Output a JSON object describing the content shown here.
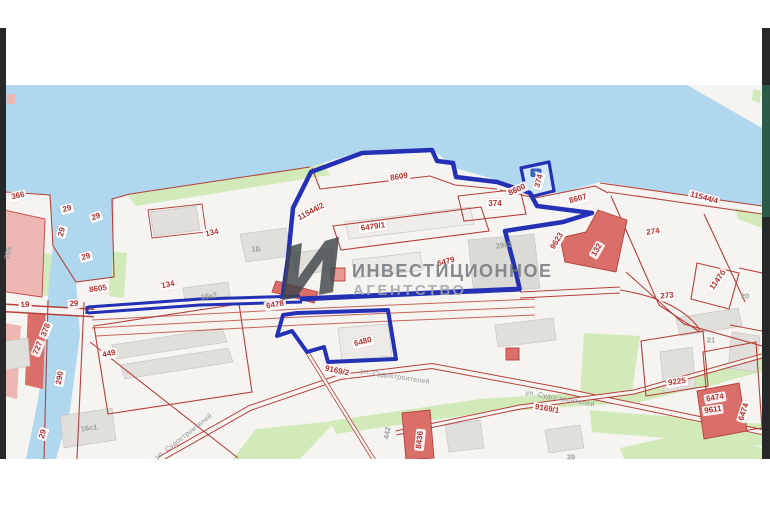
{
  "watermark": {
    "line1": "ИНВЕСТИЦИОННОЕ",
    "line2": "АГЕНТСТВО"
  },
  "map": {
    "type": "cadastral-parcel-map",
    "palette": {
      "water": "#afd7ee",
      "green": "#d2e9ba",
      "parcel_line": "#b5403c",
      "building_red": "#da6f6a",
      "building_pink": "#efb7b4",
      "selection_blue": "#2531b5",
      "label_red": "#b3322e",
      "label_gray": "#9aa09f",
      "frame_dark": "#26282a"
    },
    "labels": [
      {
        "text": "366",
        "x": 18,
        "y": 196,
        "rot": -12,
        "kind": "parcel"
      },
      {
        "text": "29",
        "x": 67,
        "y": 209,
        "rot": -15,
        "kind": "parcel"
      },
      {
        "text": "29",
        "x": 96,
        "y": 217,
        "rot": -20,
        "kind": "parcel"
      },
      {
        "text": "29",
        "x": 62,
        "y": 232,
        "rot": -75,
        "kind": "parcel"
      },
      {
        "text": "29",
        "x": 86,
        "y": 257,
        "rot": -15,
        "kind": "parcel"
      },
      {
        "text": "8605",
        "x": 98,
        "y": 289,
        "rot": -8,
        "kind": "parcel"
      },
      {
        "text": "29",
        "x": 74,
        "y": 304,
        "rot": -5,
        "kind": "parcel"
      },
      {
        "text": "19",
        "x": 25,
        "y": 305,
        "rot": -3,
        "kind": "parcel"
      },
      {
        "text": "134",
        "x": 212,
        "y": 233,
        "rot": -12,
        "kind": "parcel"
      },
      {
        "text": "134",
        "x": 168,
        "y": 285,
        "rot": -12,
        "kind": "parcel"
      },
      {
        "text": "16к2",
        "x": 209,
        "y": 296,
        "rot": -8,
        "kind": "gray"
      },
      {
        "text": "1Б",
        "x": 256,
        "y": 249,
        "rot": 0,
        "kind": "gray"
      },
      {
        "text": "11544/2",
        "x": 311,
        "y": 212,
        "rot": -28,
        "kind": "parcel"
      },
      {
        "text": "8609",
        "x": 399,
        "y": 177,
        "rot": -10,
        "kind": "parcel"
      },
      {
        "text": "6479/1",
        "x": 373,
        "y": 227,
        "rot": -8,
        "kind": "parcel"
      },
      {
        "text": "6479",
        "x": 446,
        "y": 262,
        "rot": -15,
        "kind": "parcel"
      },
      {
        "text": "374",
        "x": 495,
        "y": 204,
        "rot": 0,
        "kind": "parcel"
      },
      {
        "text": "8600",
        "x": 517,
        "y": 190,
        "rot": -25,
        "kind": "parcel"
      },
      {
        "text": "374",
        "x": 539,
        "y": 181,
        "rot": -75,
        "kind": "parcel"
      },
      {
        "text": "8607",
        "x": 578,
        "y": 199,
        "rot": -15,
        "kind": "parcel"
      },
      {
        "text": "9623",
        "x": 557,
        "y": 241,
        "rot": -60,
        "kind": "parcel"
      },
      {
        "text": "132",
        "x": 597,
        "y": 250,
        "rot": -60,
        "kind": "parcel"
      },
      {
        "text": "29к3",
        "x": 504,
        "y": 245,
        "rot": -8,
        "kind": "gray"
      },
      {
        "text": "274",
        "x": 653,
        "y": 232,
        "rot": -8,
        "kind": "parcel"
      },
      {
        "text": "11544/4",
        "x": 704,
        "y": 198,
        "rot": 15,
        "kind": "parcel"
      },
      {
        "text": "1147б",
        "x": 718,
        "y": 280,
        "rot": -55,
        "kind": "parcel"
      },
      {
        "text": "273",
        "x": 667,
        "y": 296,
        "rot": -5,
        "kind": "parcel"
      },
      {
        "text": "20",
        "x": 745,
        "y": 296,
        "rot": 0,
        "kind": "gray"
      },
      {
        "text": "21",
        "x": 711,
        "y": 340,
        "rot": 0,
        "kind": "gray"
      },
      {
        "text": "9225",
        "x": 677,
        "y": 382,
        "rot": -8,
        "kind": "parcel"
      },
      {
        "text": "6474",
        "x": 715,
        "y": 398,
        "rot": -10,
        "kind": "parcel"
      },
      {
        "text": "6474",
        "x": 744,
        "y": 412,
        "rot": -72,
        "kind": "parcel"
      },
      {
        "text": "9611",
        "x": 713,
        "y": 410,
        "rot": -8,
        "kind": "parcel"
      },
      {
        "text": "9169/1",
        "x": 547,
        "y": 409,
        "rot": 10,
        "kind": "parcel"
      },
      {
        "text": "ул. Судостроителей",
        "x": 560,
        "y": 399,
        "rot": 10,
        "kind": "street"
      },
      {
        "text": "9169/2",
        "x": 337,
        "y": 371,
        "rot": 12,
        "kind": "parcel"
      },
      {
        "text": "ул. Судостроителей",
        "x": 395,
        "y": 377,
        "rot": 9,
        "kind": "street"
      },
      {
        "text": "ул. Судостроителей",
        "x": 184,
        "y": 437,
        "rot": -38,
        "kind": "street"
      },
      {
        "text": "6478",
        "x": 275,
        "y": 305,
        "rot": -10,
        "kind": "parcel"
      },
      {
        "text": "6480",
        "x": 363,
        "y": 342,
        "rot": -15,
        "kind": "parcel"
      },
      {
        "text": "442",
        "x": 387,
        "y": 433,
        "rot": -80,
        "kind": "gray"
      },
      {
        "text": "8436",
        "x": 420,
        "y": 440,
        "rot": -84,
        "kind": "parcel"
      },
      {
        "text": "290",
        "x": 60,
        "y": 378,
        "rot": -80,
        "kind": "parcel"
      },
      {
        "text": "378",
        "x": 46,
        "y": 330,
        "rot": -68,
        "kind": "parcel"
      },
      {
        "text": "727",
        "x": 38,
        "y": 348,
        "rot": -68,
        "kind": "parcel"
      },
      {
        "text": "449",
        "x": 109,
        "y": 354,
        "rot": -12,
        "kind": "parcel"
      },
      {
        "text": "705",
        "x": 8,
        "y": 253,
        "rot": -80,
        "kind": "gray"
      },
      {
        "text": "16с1",
        "x": 89,
        "y": 428,
        "rot": -8,
        "kind": "gray"
      },
      {
        "text": "29",
        "x": 43,
        "y": 434,
        "rot": -73,
        "kind": "parcel"
      },
      {
        "text": "39",
        "x": 571,
        "y": 457,
        "rot": 0,
        "kind": "gray"
      }
    ]
  }
}
